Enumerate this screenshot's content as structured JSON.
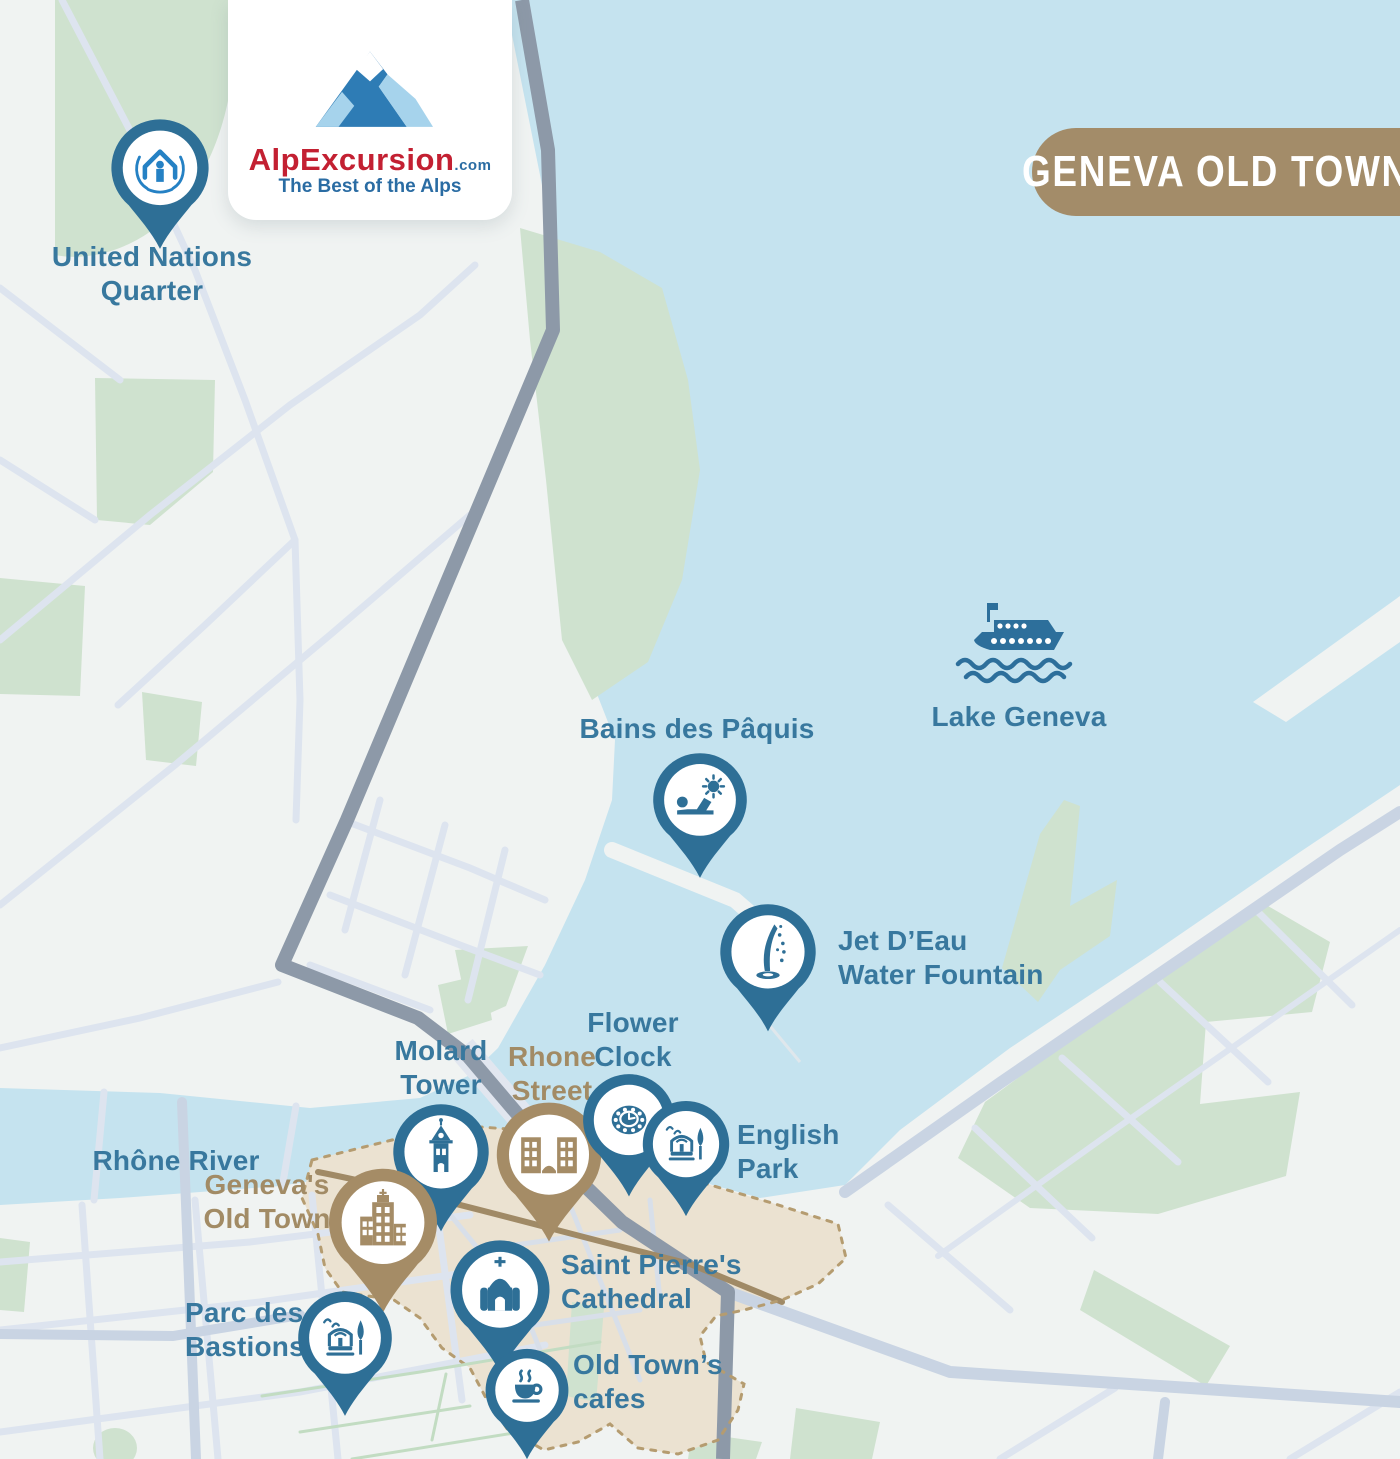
{
  "header": {
    "badge_title": "GENEVA OLD TOWN",
    "logo": {
      "brand": "AlpExcursion",
      "suffix": ".com",
      "tagline": "The Best of the Alps"
    }
  },
  "map_labels": {
    "lake": "Lake Geneva",
    "river": "Rhône River"
  },
  "markers": [
    {
      "id": "united-nations-quarter",
      "lines": [
        "United Nations",
        "Quarter"
      ],
      "theme": "blue",
      "icon": "un-emblem-icon"
    },
    {
      "id": "bains-des-paquis",
      "lines": [
        "Bains des Pâquis",
        ""
      ],
      "theme": "blue",
      "icon": "sunbather-icon"
    },
    {
      "id": "jet-deau",
      "lines": [
        "Jet D’Eau",
        "Water Fountain"
      ],
      "theme": "blue",
      "icon": "water-jet-icon"
    },
    {
      "id": "molard-tower",
      "lines": [
        "Molard",
        "Tower"
      ],
      "theme": "blue",
      "icon": "tower-icon"
    },
    {
      "id": "rhone-street",
      "lines": [
        "Rhone",
        "Street"
      ],
      "theme": "tan",
      "icon": "buildings-icon"
    },
    {
      "id": "flower-clock",
      "lines": [
        "Flower",
        "Clock"
      ],
      "theme": "blue",
      "icon": "clock-icon"
    },
    {
      "id": "english-park",
      "lines": [
        "English",
        "Park"
      ],
      "theme": "blue",
      "icon": "park-fountain-icon"
    },
    {
      "id": "genevas-old-town",
      "lines": [
        "Geneva's",
        "Old Town"
      ],
      "theme": "tan",
      "icon": "old-town-buildings-icon"
    },
    {
      "id": "saint-pierres-cathedral",
      "lines": [
        "Saint Pierre's",
        "Cathedral"
      ],
      "theme": "blue",
      "icon": "cathedral-icon"
    },
    {
      "id": "parc-des-bastions",
      "lines": [
        "Parc des",
        "Bastions"
      ],
      "theme": "blue",
      "icon": "fountain-birds-icon"
    },
    {
      "id": "old-towns-cafes",
      "lines": [
        "Old Town’s",
        "cafes"
      ],
      "theme": "blue",
      "icon": "coffee-cup-icon"
    }
  ],
  "colors": {
    "pin_blue": "#2e6f96",
    "pin_tan": "#a58c66",
    "label_blue": "#38789e",
    "label_tan": "#a28b65",
    "water": "#c5e3ef",
    "park": "#cfe2cf",
    "land": "#f0f3f2",
    "road_light": "#dde4ef",
    "road_medium": "#c9d4e3",
    "route_gray": "#8d99a8",
    "route_tan": "#a08a66",
    "old_town_fill": "#ebe2d1",
    "old_town_border": "#b59c70",
    "badge_bg": "#a38c69",
    "logo_red": "#c32032",
    "logo_blue": "#2a6ca3",
    "emblem_blue": "#2581c4"
  }
}
